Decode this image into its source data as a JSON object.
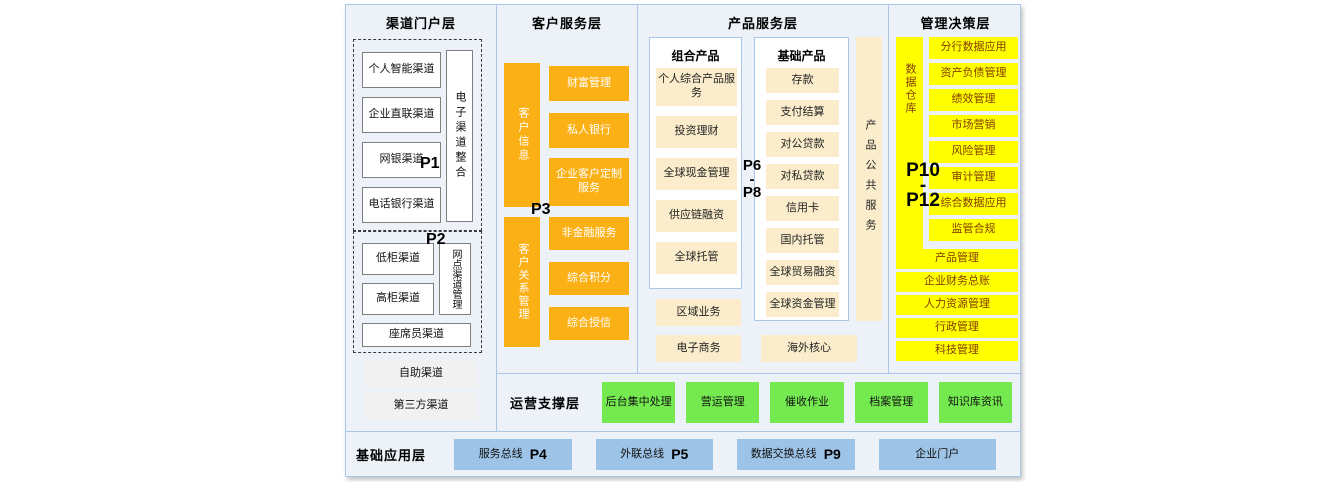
{
  "colors": {
    "bg": "#EDF2F9",
    "border": "#A9C7E8",
    "orange": "#FBB116",
    "cream": "#FBEDCB",
    "yellow": "#FFFF00",
    "yellow_text": "#833C00",
    "green": "#75EA50",
    "blue": "#9DC3E6"
  },
  "channel_layer": {
    "title": "渠道门户层",
    "p1": "P1",
    "p2": "P2",
    "group1": {
      "items": [
        "个人智能渠道",
        "企业直联渠道",
        "网银渠道",
        "电话银行渠道"
      ],
      "vertical": "电子渠道整合"
    },
    "group2": {
      "items": [
        "低柜渠道",
        "高柜渠道"
      ],
      "vertical": "网点渠道管理",
      "wide": "座席员渠道"
    },
    "extra": [
      "自助渠道",
      "第三方渠道"
    ]
  },
  "customer_layer": {
    "title": "客户服务层",
    "p3": "P3",
    "vertical1": "客户信息",
    "group1": [
      "财富管理",
      "私人银行",
      "企业客户定制服务"
    ],
    "vertical2": "客户关系管理",
    "group2": [
      "非金融服务",
      "综合积分",
      "综合授信"
    ]
  },
  "product_layer": {
    "title": "产品服务层",
    "p_range": [
      "P6",
      "-",
      "P8"
    ],
    "combo": {
      "title": "组合产品",
      "items": [
        "个人综合产品服务",
        "投资理财",
        "全球现金管理",
        "供应链融资",
        "全球托管"
      ]
    },
    "basic": {
      "title": "基础产品",
      "items": [
        "存款",
        "支付结算",
        "对公贷款",
        "对私贷款",
        "信用卡",
        "国内托管",
        "全球贸易融资",
        "全球资金管理"
      ]
    },
    "vertical": "产品公共服务",
    "extra_left": [
      "区域业务",
      "电子商务"
    ],
    "extra_right": "海外核心"
  },
  "management_layer": {
    "title": "管理决策层",
    "p_range": [
      "P10",
      "-",
      "P12"
    ],
    "vertical": "数据仓库",
    "items": [
      "分行数据应用",
      "资产负债管理",
      "绩效管理",
      "市场营销",
      "风险管理",
      "审计管理",
      "综合数据应用",
      "监管合规"
    ],
    "wide_items": [
      "产品管理",
      "企业财务总账",
      "人力资源管理",
      "行政管理",
      "科技管理"
    ]
  },
  "ops_layer": {
    "title": "运营支撑层",
    "items": [
      "后台集中处理",
      "营运管理",
      "催收作业",
      "档案管理",
      "知识库资讯"
    ]
  },
  "base_layer": {
    "title": "基础应用层",
    "items": [
      {
        "label": "服务总线",
        "p": "P4"
      },
      {
        "label": "外联总线",
        "p": "P5"
      },
      {
        "label": "数据交换总线",
        "p": "P9"
      },
      {
        "label": "企业门户",
        "p": ""
      }
    ]
  }
}
